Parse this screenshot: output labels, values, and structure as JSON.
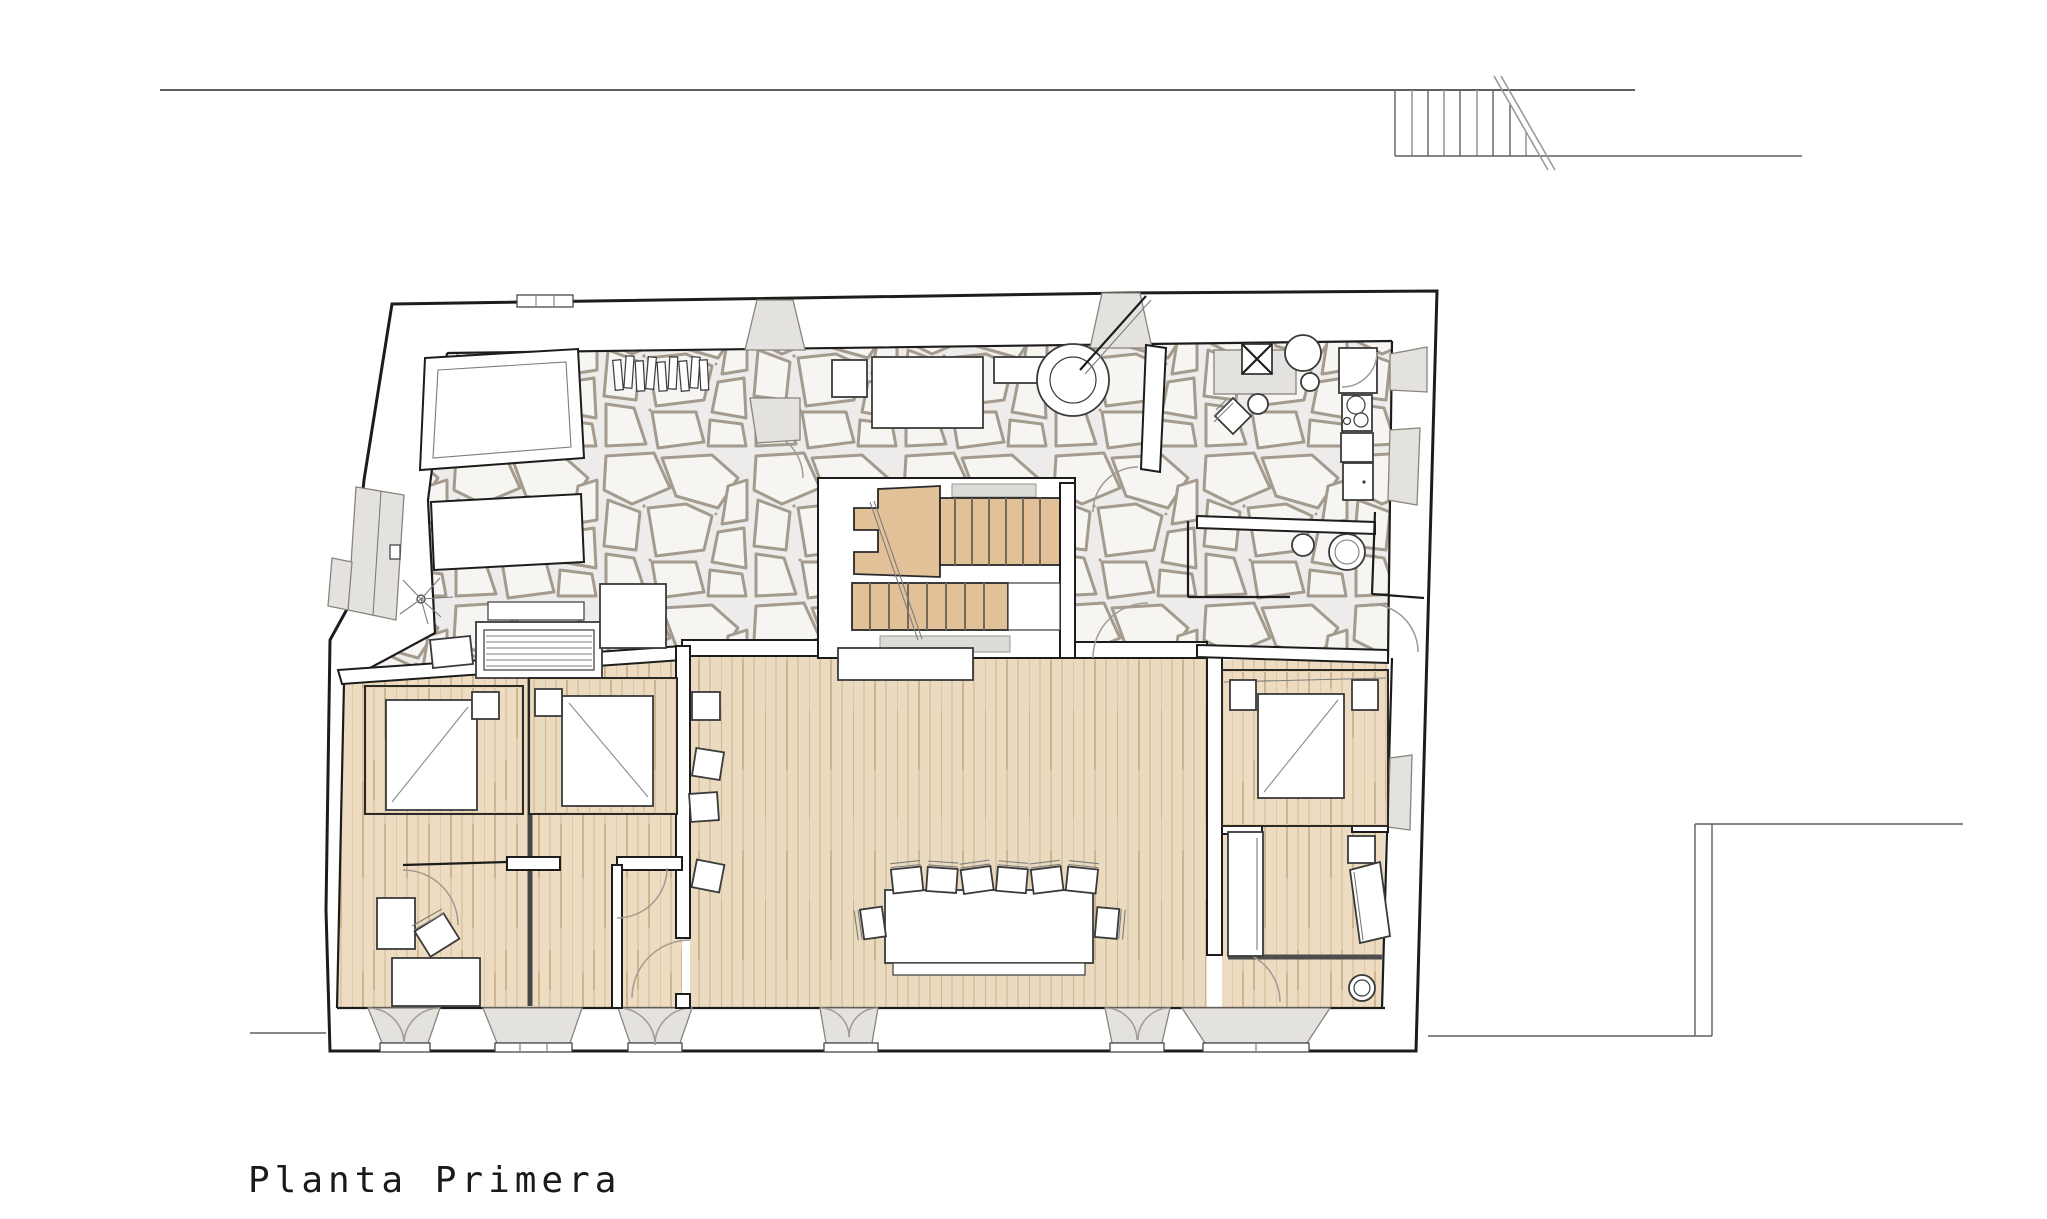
{
  "title": {
    "text": "Planta Primera"
  },
  "colors": {
    "wall_line": "#1c1c1c",
    "site_line": "#5f5f5f",
    "stone_joint": "#a49b8e",
    "stone_bg": "#edecea",
    "wood_fill": "#eddcc1",
    "wood_line": "#d6bd98",
    "stair_fill": "#e2c098",
    "bed_fill": "#e7cda6",
    "gray_fill": "#e3e2df",
    "arc_line": "#a39b90"
  }
}
